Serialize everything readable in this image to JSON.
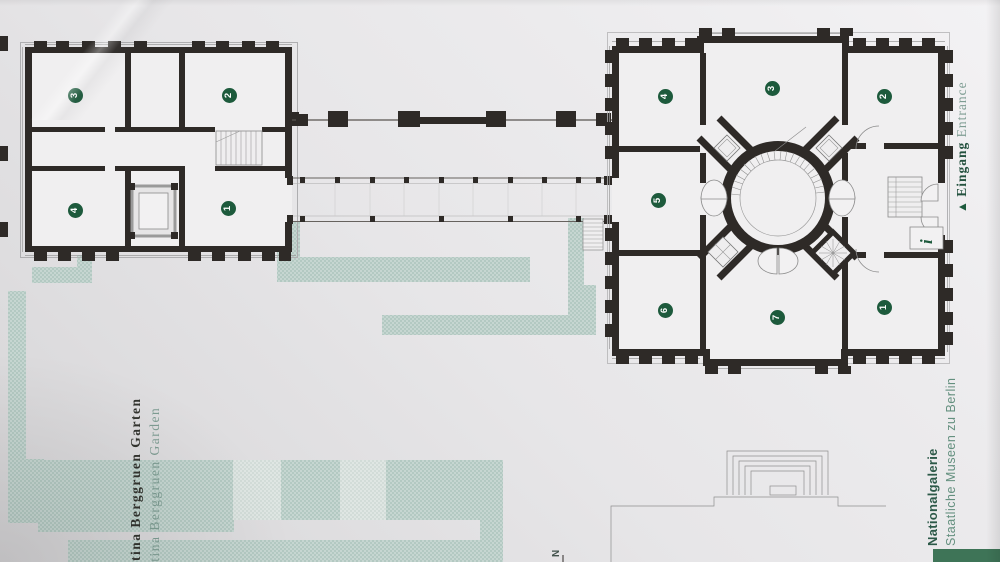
{
  "labels": {
    "garden_de": "Bettina Berggruen Garten",
    "garden_en": "Bettina Berggruen Garden",
    "entrance_arrow": "▲",
    "entrance_de": "Eingang",
    "entrance_en": "Entrance",
    "north": "N",
    "info_icon": "i"
  },
  "title_block": {
    "museum": "Nationalgalerie",
    "institution": "Staatliche Museen zu Berlin"
  },
  "rooms": {
    "west_wing": [
      "3",
      "2",
      "4",
      "1"
    ],
    "main_building": [
      "4",
      "3",
      "2",
      "5",
      "6",
      "7",
      "1"
    ]
  },
  "colors": {
    "accent_green": "#1d5a3c",
    "text_green": "#7e9d93",
    "title_green": "#2c5948",
    "garden_path": "#bccfc9",
    "wall_black": "#2e2a27",
    "banner_green": "#3e7457"
  }
}
